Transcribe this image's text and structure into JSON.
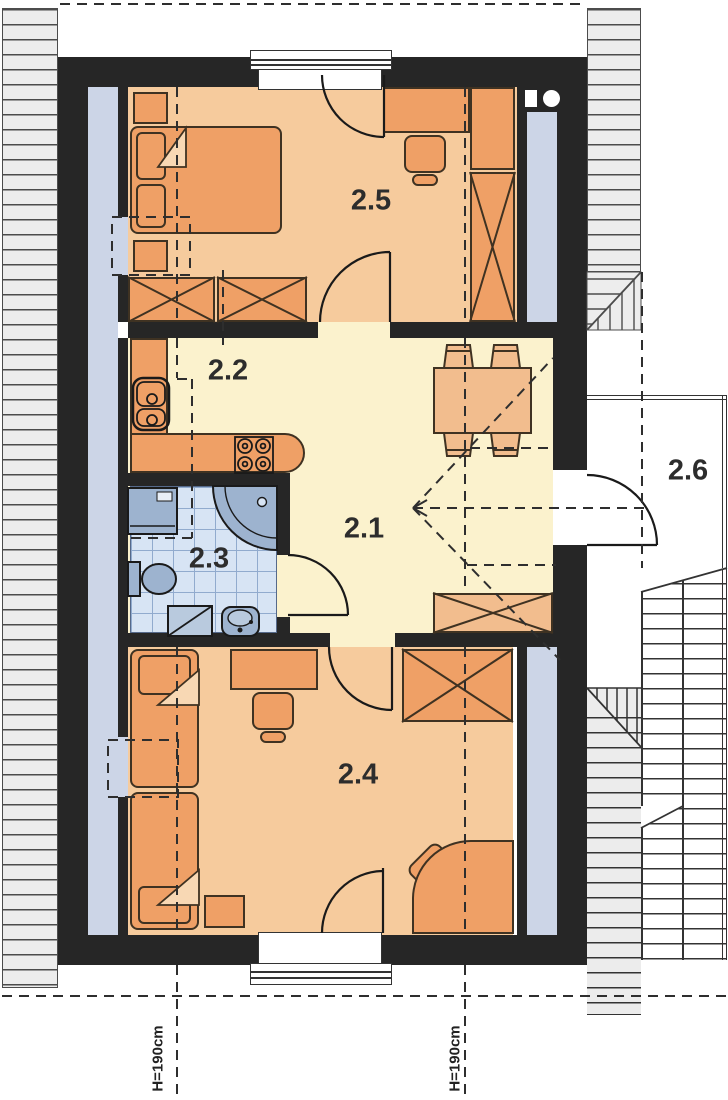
{
  "plan": {
    "type": "attic floor plan",
    "rooms": [
      {
        "number": "2.1"
      },
      {
        "number": "2.2"
      },
      {
        "number": "2.3"
      },
      {
        "number": "2.4"
      },
      {
        "number": "2.5"
      },
      {
        "number": "2.6"
      }
    ],
    "annotations": {
      "height_left": "H=190cm",
      "height_right": "H=190cm"
    },
    "colors": {
      "wall": "#262626",
      "bedroom_floor": "#f6cb9d",
      "hall_floor": "#fbf2cd",
      "furniture": "#efa066",
      "furniture_light": "#f2bd8e",
      "bathroom_tile": "#d7e4f4",
      "tile_line": "#91abce",
      "fixture": "#9db3cf",
      "knee_wall_space": "#ccd5e7",
      "roof_hatch": "#ededed",
      "outline": "#3f3222"
    }
  }
}
